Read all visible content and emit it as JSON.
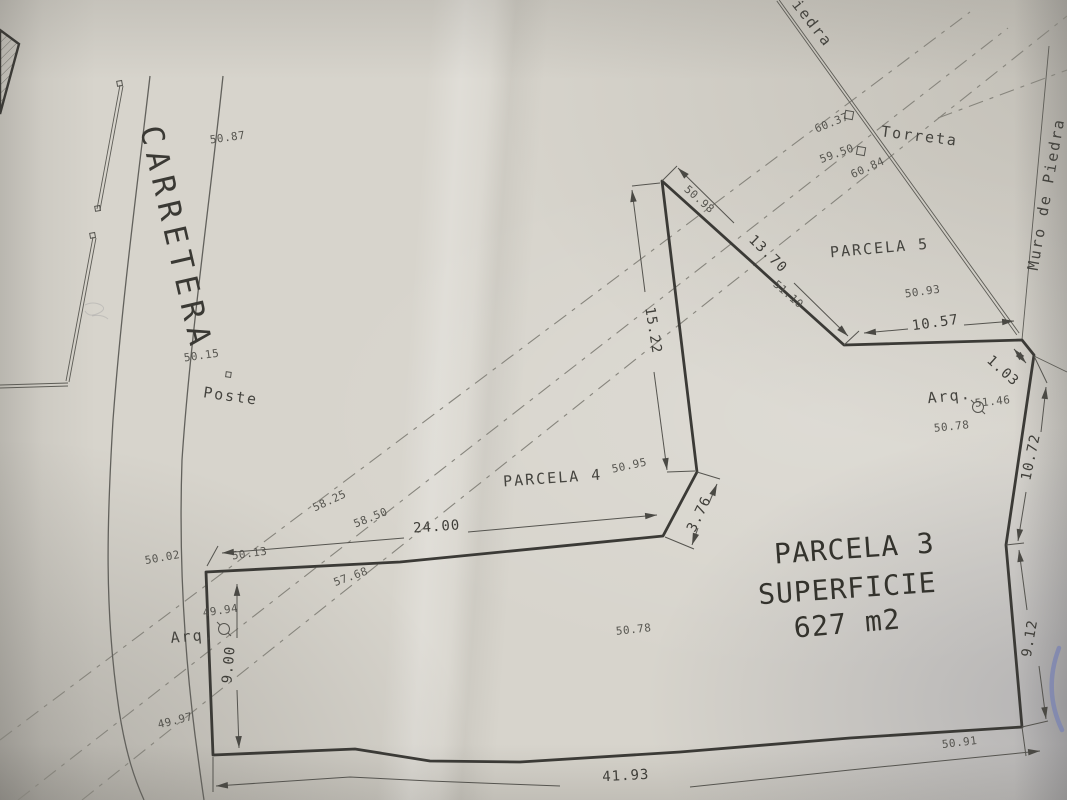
{
  "drawing": {
    "road": {
      "label": "CARRETERA"
    },
    "parcels": {
      "p3": {
        "name": "PARCELA 3",
        "surface_label": "SUPERFICIE",
        "area": "627 m2"
      },
      "p4": {
        "name": "PARCELA 4"
      },
      "p5": {
        "name": "PARCELA 5"
      }
    },
    "features": {
      "poste": "Poste",
      "torreta": "Torreta",
      "muro_de_piedra": "Muro de Piedra",
      "muro_top_partial": "Piedra",
      "arq_left": "Arq.",
      "arq_right": "Arq."
    },
    "dimensions": {
      "top_edge": "24.00",
      "jog": "3.76",
      "west_spike": "15.22",
      "p5_southwest": "13.70",
      "p5_south": "10.57",
      "corner_jog": "1.03",
      "east_upper": "10.72",
      "east_lower": "9.12",
      "west_edge": "9.00",
      "south_edge": "41.93"
    },
    "spot_elevations": {
      "road_north": "50.87",
      "road_mid": "50.15",
      "road_south": "50.02",
      "corner_left": "50.13",
      "arq_left_elev": "49.94",
      "southwest": "49.97",
      "contour_a": "58.25",
      "contour_b": "58.50",
      "contour_c": "57.68",
      "spike_top": "50.98",
      "spike_bottom": "50.95",
      "p5_slope": "51.10",
      "p5_east": "50.93",
      "wall_a": "60.37",
      "wall_b": "59.50",
      "wall_c": "60.84",
      "arq_right_elev": "51.46",
      "east_mid": "50.78",
      "center": "50.78",
      "south_right": "50.91"
    },
    "colors": {
      "paper": "#d7d4cc",
      "ink": "#3b3a36",
      "blue_mark": "#7c84b2"
    }
  }
}
